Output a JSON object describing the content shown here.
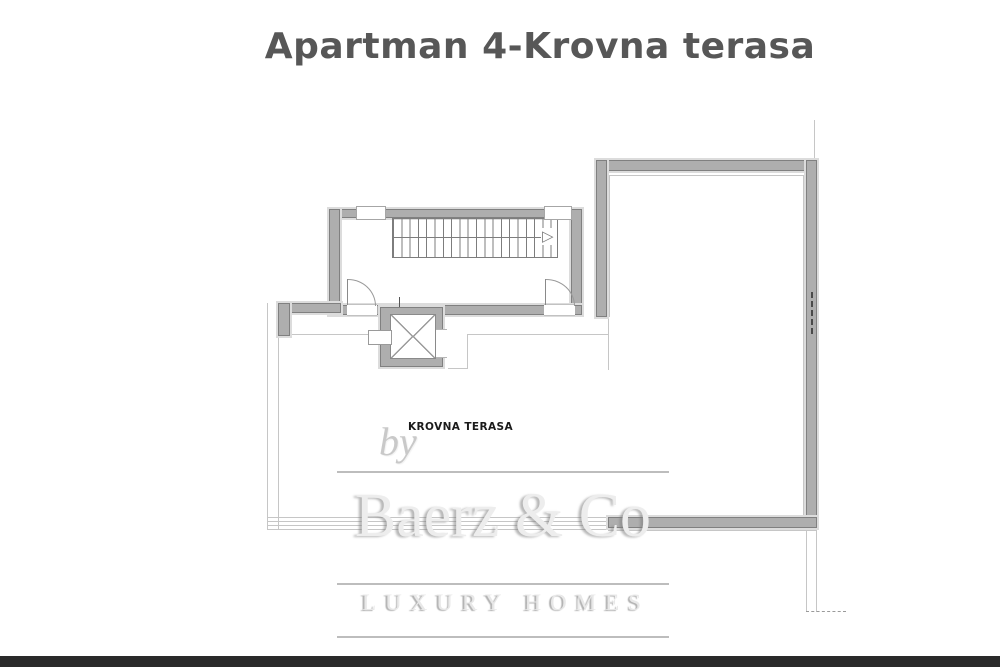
{
  "page": {
    "title": "Apartman 4-Krovna terasa"
  },
  "plan": {
    "room_label": "KROVNA TERASA",
    "stairs_arrow": "▷"
  },
  "watermark": {
    "by": "by",
    "brand": "Baerz & Co",
    "tagline": "LUXURY HOMES"
  },
  "colors": {
    "wall_fill": "#aeaeae",
    "wall_border": "#808080",
    "wall_halo": "#dcdcdc",
    "thin_line": "#c6c6c6",
    "stair_line": "#7d7d7d",
    "title_text": "#575757",
    "label_text": "#1b1b1b",
    "wm_gray": "#b2b2b2",
    "bottom_bar": "#2a2a2a"
  }
}
